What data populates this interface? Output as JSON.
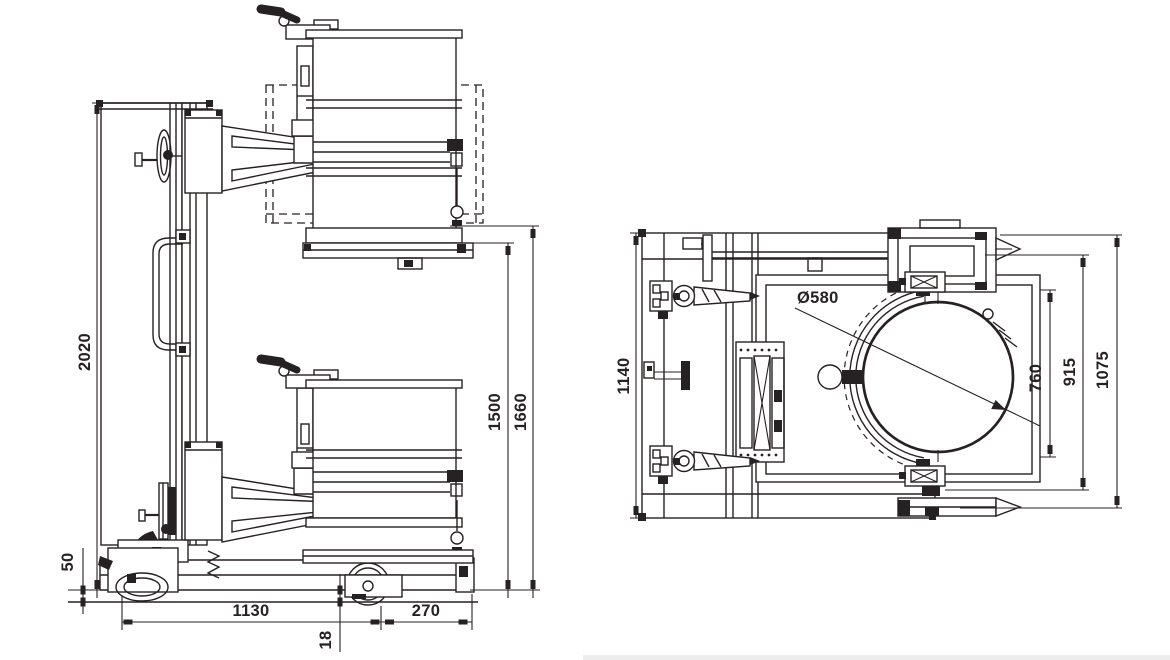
{
  "page": {
    "background_color": "#ffffff",
    "line_color": "#262122",
    "footer_strip_color": "#ededed"
  },
  "side_view": {
    "title": "drum lifter side elevation",
    "dims": {
      "overall_height": "2020",
      "chassis_clearance": "50",
      "base_length": "1130",
      "fork_overhang": "270",
      "lowered_clearance": "18",
      "lift_height": "1500",
      "max_height": "1660"
    }
  },
  "top_view": {
    "title": "drum lifter plan view",
    "dims": {
      "overall_width": "1140",
      "drum_diameter": "Ø580",
      "clamp_opening": "760",
      "frame_width": "915",
      "overall_length": "1075"
    }
  }
}
